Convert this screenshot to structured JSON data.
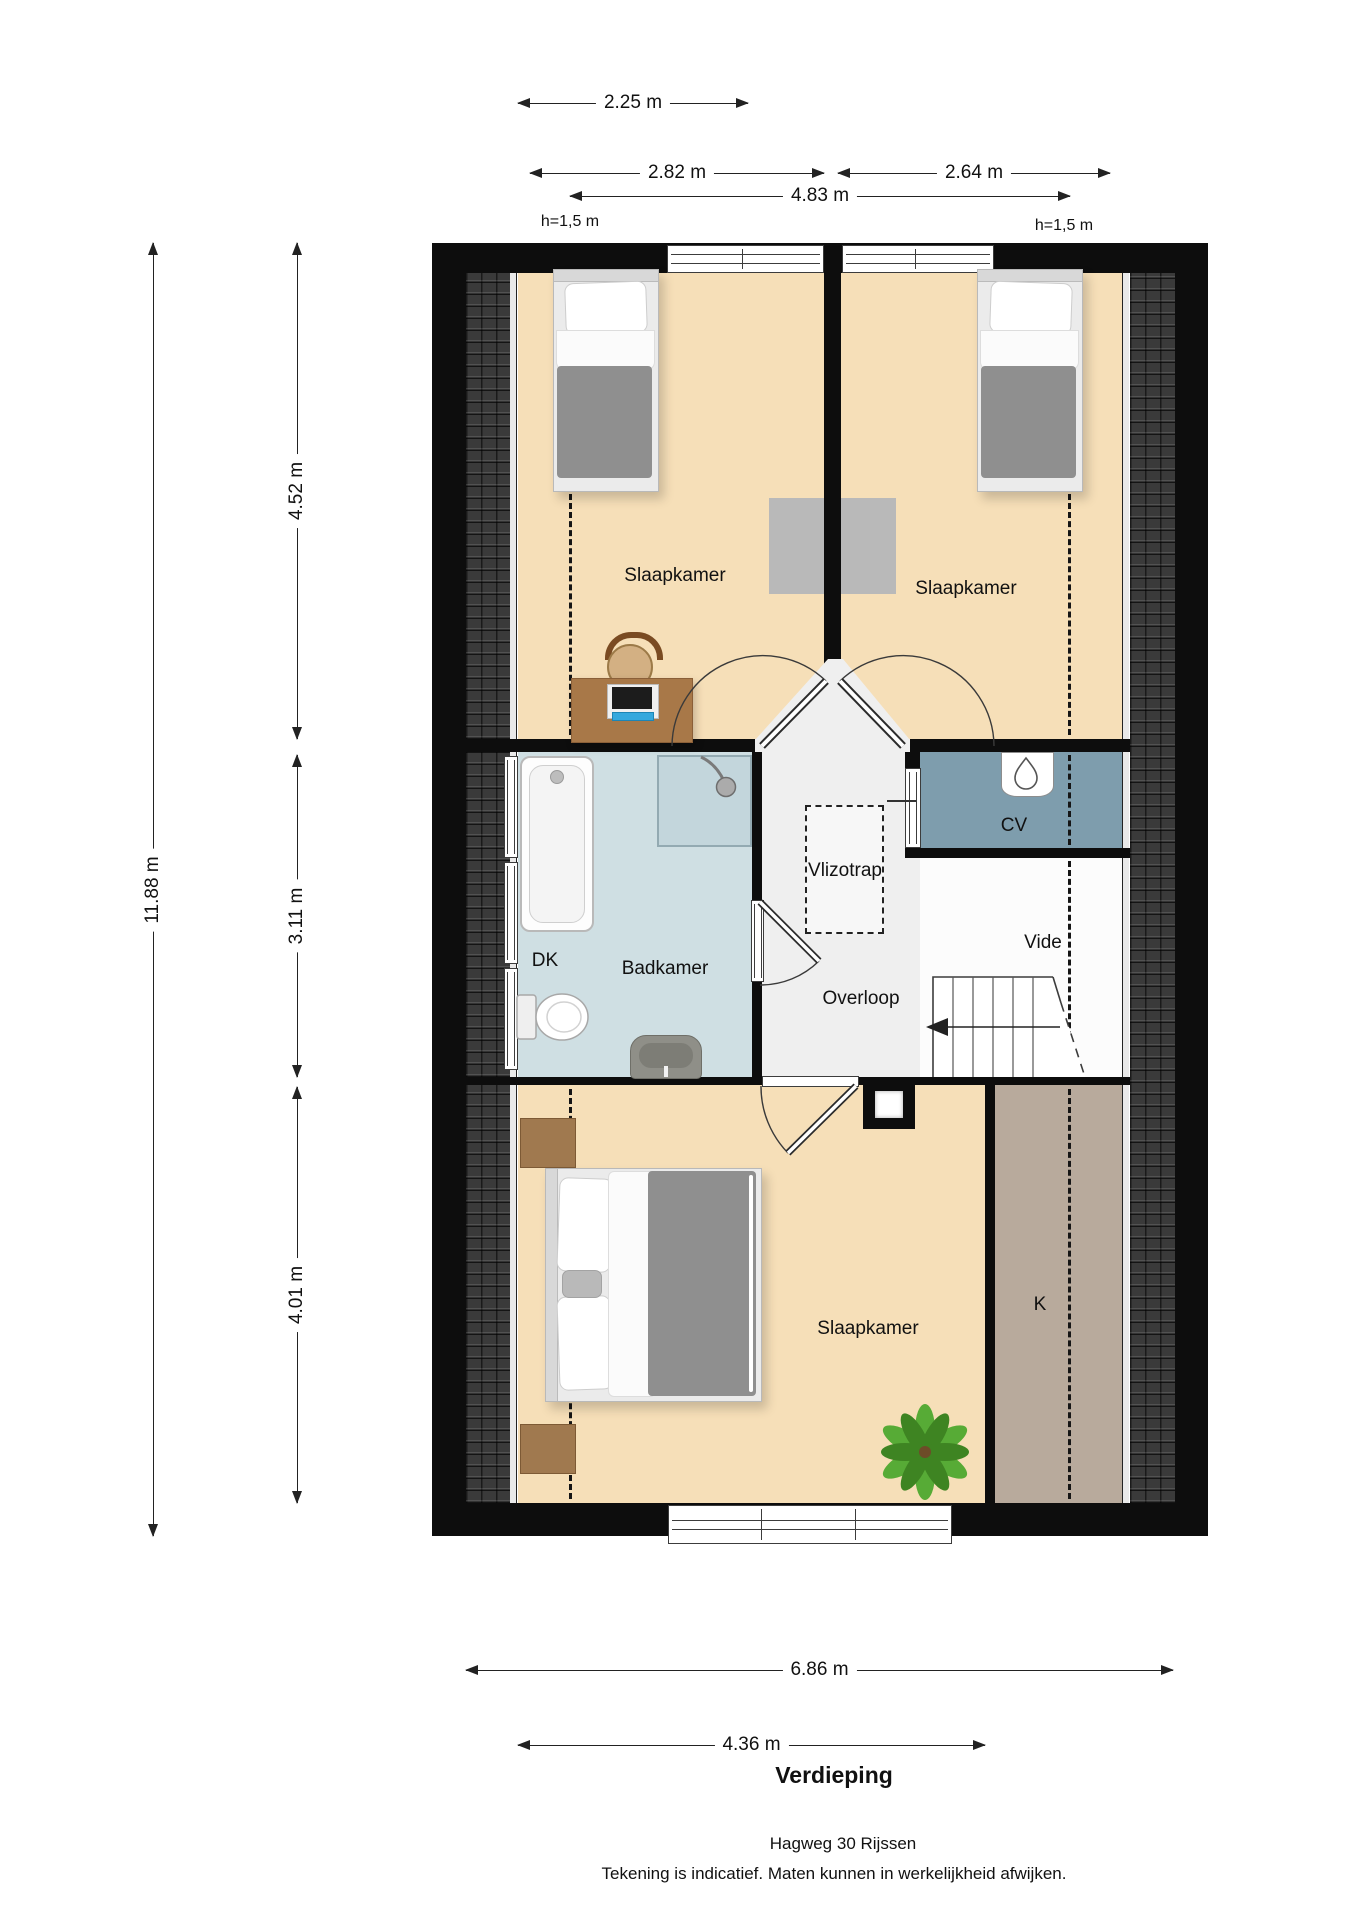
{
  "plan": {
    "title": "Verdieping",
    "address": "Hagweg 30 Rijssen",
    "disclaimer": "Tekening is indicatief. Maten kunnen in werkelijkheid afwijken.",
    "height_left": "h=1,5 m",
    "height_right": "h=1,5 m",
    "rooms": {
      "slaapkamer_left": "Slaapkamer",
      "slaapkamer_right": "Slaapkamer",
      "slaapkamer_bottom": "Slaapkamer",
      "badkamer": "Badkamer",
      "overloop": "Overloop",
      "vlizotrap": "Vlizotrap",
      "vide": "Vide",
      "cv": "CV",
      "dk": "DK",
      "k": "K"
    },
    "dimensions": {
      "top": [
        {
          "label": "2.25 m"
        },
        {
          "label": "2.82 m"
        },
        {
          "label": "2.64 m"
        },
        {
          "label": "4.83 m"
        }
      ],
      "left": [
        {
          "label": "11.88 m"
        },
        {
          "label": "4.52 m"
        },
        {
          "label": "3.11 m"
        },
        {
          "label": "4.01 m"
        }
      ],
      "bottom": [
        {
          "label": "6.86 m"
        },
        {
          "label": "4.36 m"
        }
      ]
    },
    "colors": {
      "wall": "#0d0d0d",
      "floor": "#f6dfb8",
      "bathroom": "#cfdfe3",
      "cv_room": "#7e9dad",
      "closet": "#b8aa9c",
      "hall": "#efefef",
      "roof_tiles": "#3a3a3a"
    }
  }
}
